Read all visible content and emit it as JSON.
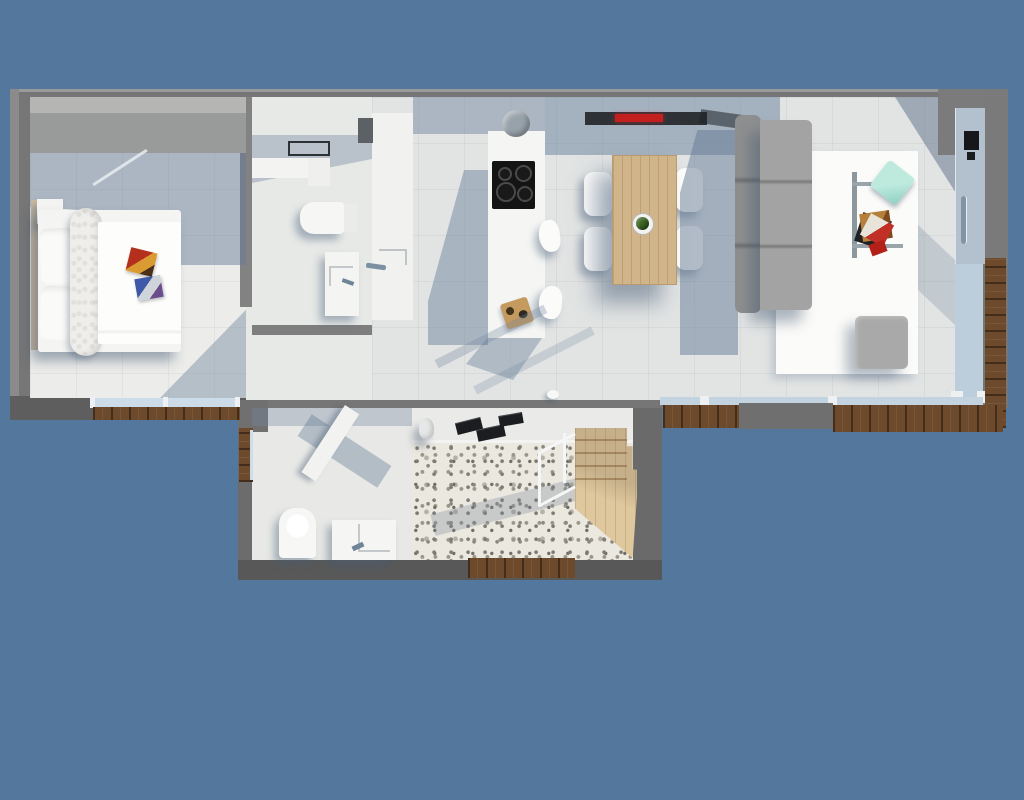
{
  "scene": {
    "type": "3d-floorplan-render",
    "view": "top-down",
    "background_color": "#54779d",
    "text_visible": "none"
  },
  "palette": {
    "exterior_wall": "#767676",
    "interior_wall": "#828282",
    "floor_light": "#ecedea",
    "floor_living": "#e2e4e4",
    "shadow_blue": "#64779b",
    "glass": "#c3d4e0",
    "wood_deck": "#6d4a2b",
    "wood_furniture": "#d0b58b",
    "sofa_gray": "#a2a3a2",
    "rug_white": "#fbfbf9",
    "accent_red": "#c41f1f",
    "accent_teal": "#9fdfd0",
    "cooktop_black": "#141414",
    "gravel": "#ebe8e0"
  },
  "rooms": {
    "bedroom": {
      "name": "bedroom",
      "items": [
        "wardrobe",
        "double-bed",
        "pillows",
        "knit-throw",
        "magazines",
        "nightstand",
        "window"
      ]
    },
    "bathroom": {
      "name": "bathroom",
      "items": [
        "wall-mirror",
        "counter",
        "toilet",
        "vanity-sink",
        "shower-column",
        "shower-handle"
      ]
    },
    "kitchen": {
      "name": "kitchen",
      "items": [
        "island-counter",
        "cooktop",
        "extractor-hood",
        "bar-stools",
        "cutting-board"
      ],
      "cooktop_burners": 4,
      "stool_count": 2
    },
    "dining": {
      "name": "dining-area",
      "items": [
        "wooden-table",
        "chairs",
        "potted-plant",
        "sideboard",
        "red-hifi-unit"
      ],
      "chair_count": 4
    },
    "living": {
      "name": "living-room",
      "items": [
        "sofa",
        "white-rug",
        "coffee-table",
        "teal-cushion",
        "magazine-stack",
        "ottoman",
        "entry-door",
        "glass-wall",
        "wood-deck"
      ],
      "sofa_seats": 3
    },
    "guest_wc": {
      "name": "guest-wc",
      "items": [
        "toilet",
        "vanity-sink",
        "open-door",
        "window"
      ]
    },
    "courtyard": {
      "name": "gravel-courtyard",
      "items": [
        "gravel-bed",
        "wooden-staircase",
        "white-railing",
        "door-mats",
        "vase",
        "wood-deck"
      ],
      "mat_count": 3
    }
  }
}
